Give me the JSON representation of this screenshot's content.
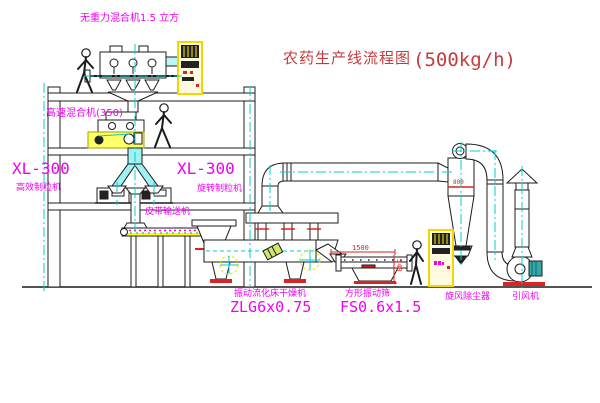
{
  "title": {
    "text": "农药生产线流程图",
    "capacity": "(500kg/h)"
  },
  "labels": {
    "gravity_mixer": "无重力混合机1.5 立方",
    "high_speed_mixer": "高速混合机(350)",
    "granulator_left_model": "XL-300",
    "granulator_left_name": "高效制粒机",
    "granulator_right_model": "XL-300",
    "granulator_right_name": "旋转制粒机",
    "belt_conveyor": "皮带输送机",
    "dryer_name": "振动流化床干燥机",
    "dryer_model": "ZLG6x0.75",
    "screen_name": "方形振动筛",
    "screen_model": "FS0.6x1.5",
    "cyclone_name": "旋风除尘器",
    "fan_name": "引风机"
  },
  "dimensions": {
    "screen_length": "1500",
    "screen_height": "540",
    "cyclone_dim": "800"
  },
  "colors": {
    "label_magenta": "#f000f0",
    "title_red": "#c43c3c",
    "line_black": "#1c1c1c",
    "centerline_cyan": "#00d0d0",
    "cabinet_yellow": "#f0d800",
    "pipe_fill_cyan": "#9ff3f3",
    "dim_red": "#dd2222"
  }
}
